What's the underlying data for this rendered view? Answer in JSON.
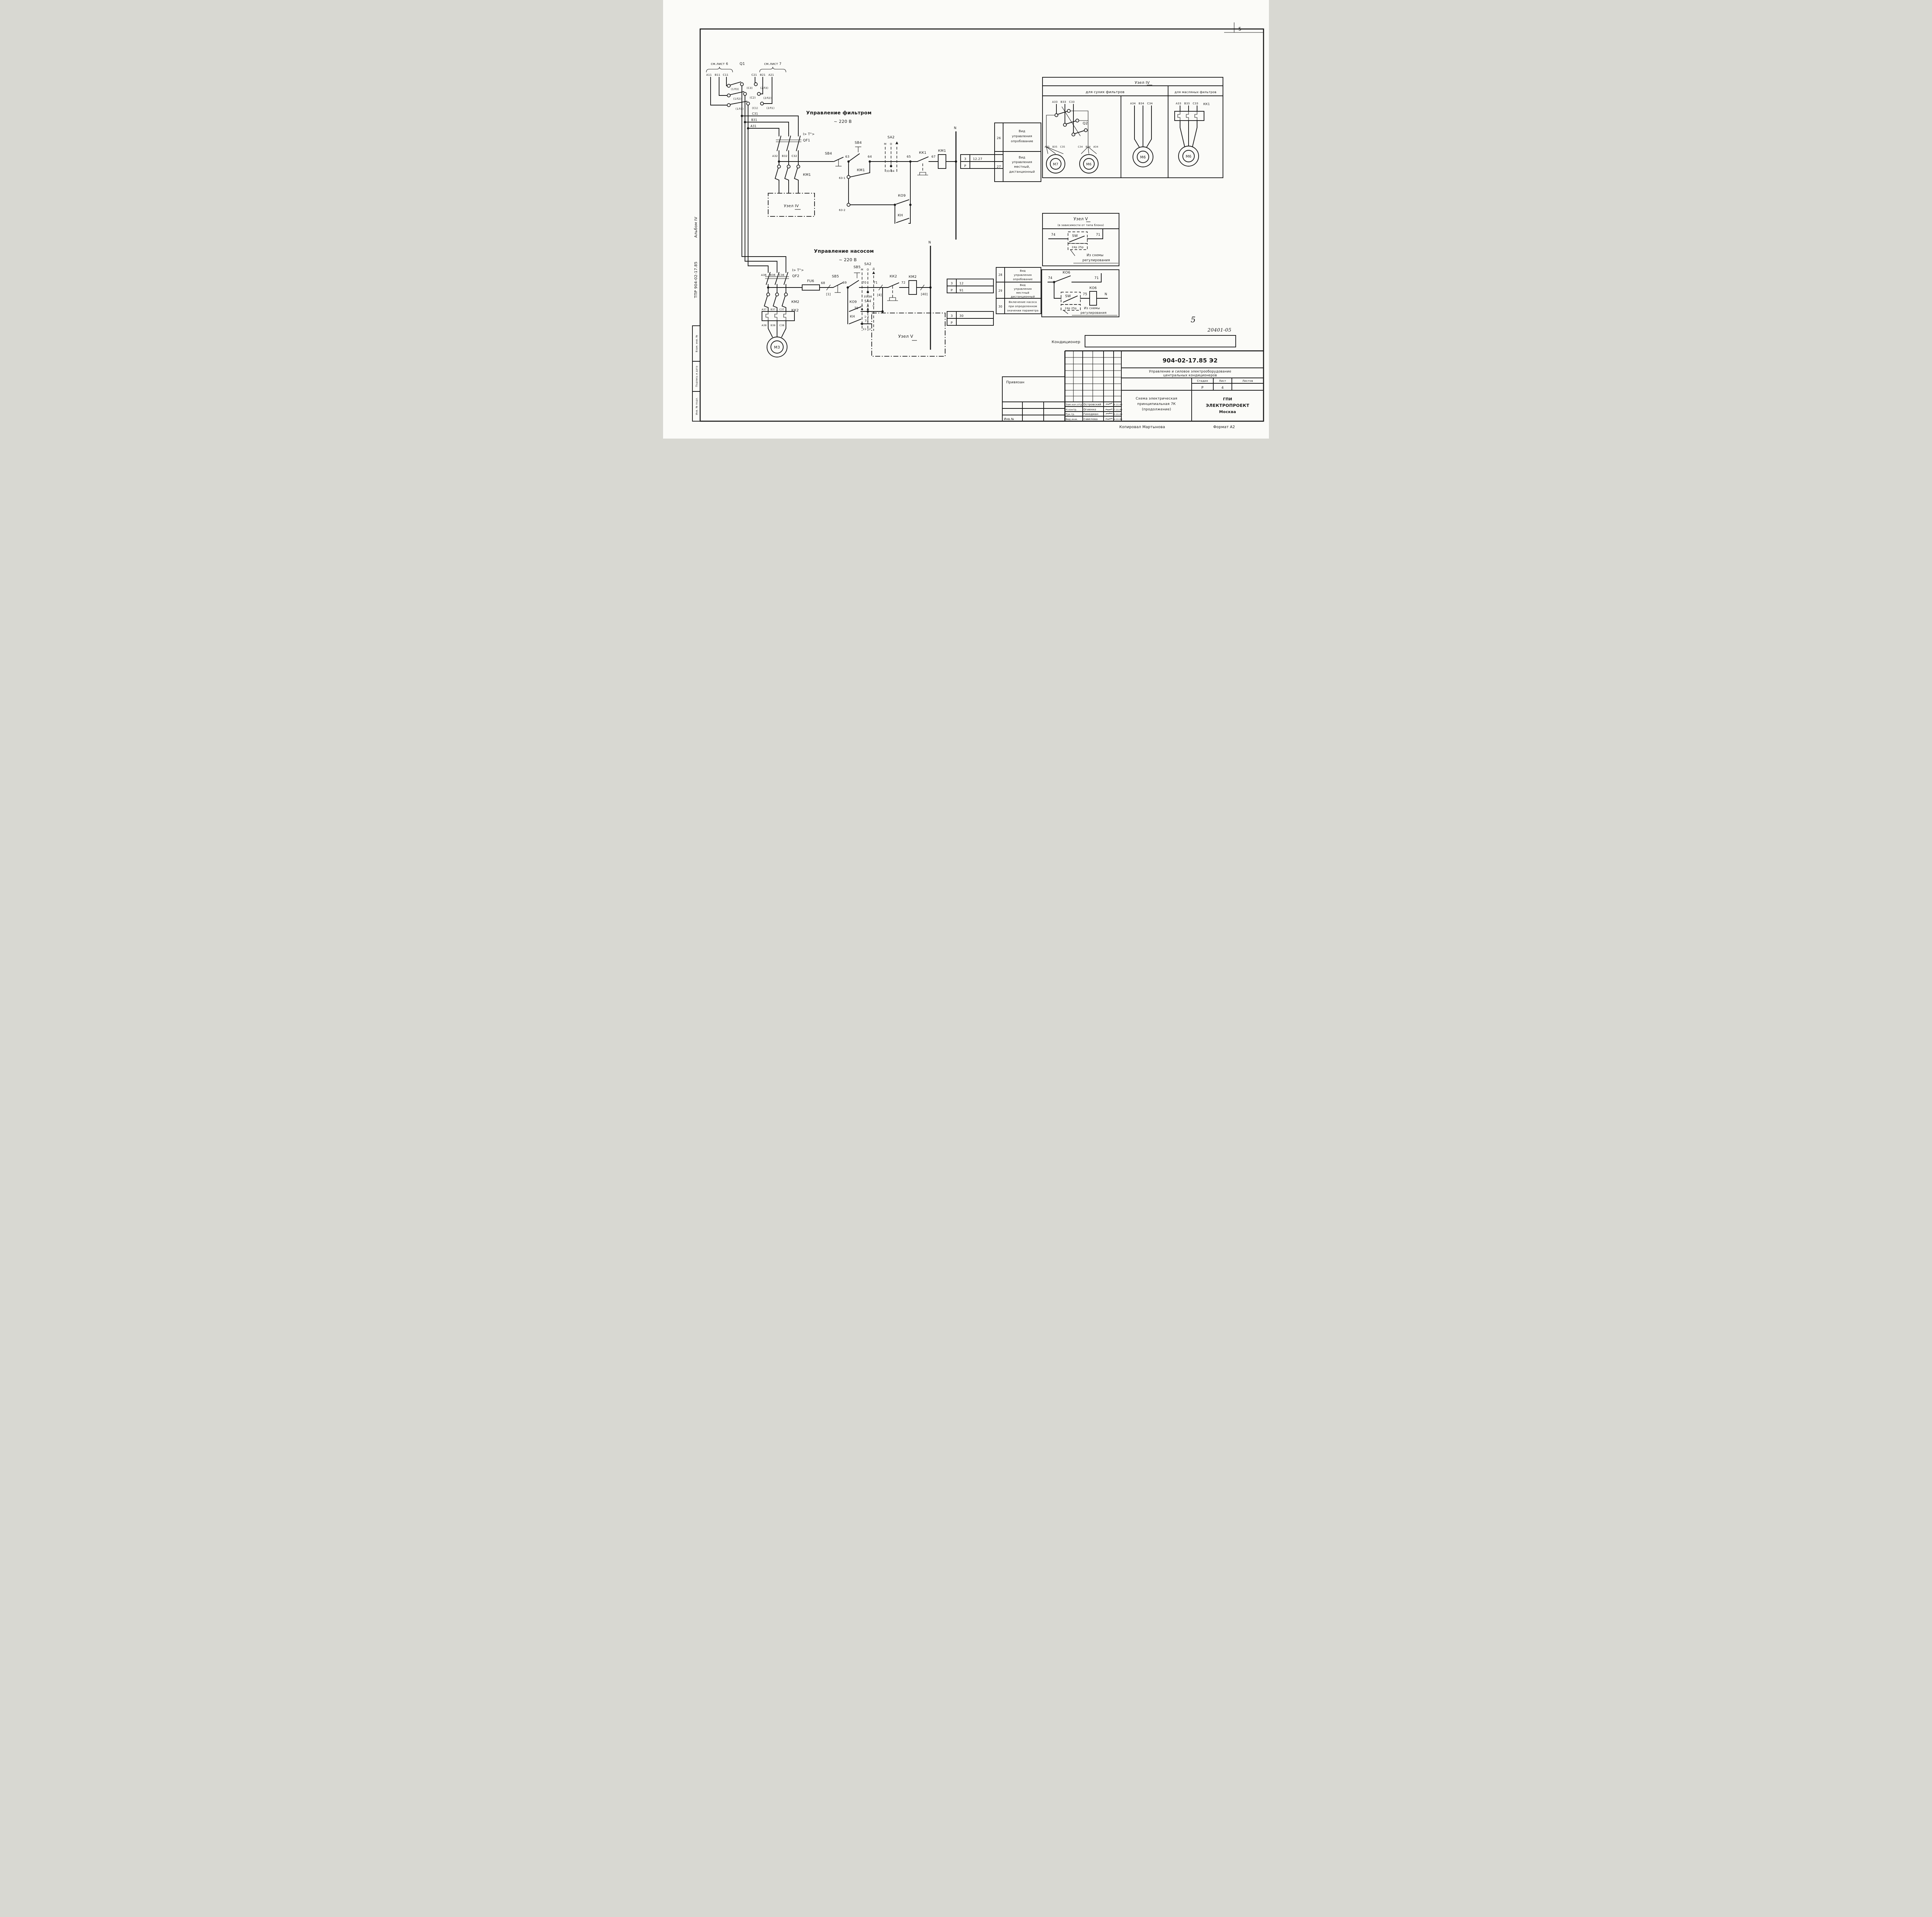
{
  "sheet": {
    "corner_num": "5",
    "hand_num": "5",
    "hand_code": "20401-05",
    "conditioner": "Кондиционер",
    "side_tpr": "ТПР  904-02-17.85",
    "side_album": "Альбом IV",
    "stamps": [
      "Взам. инв. №",
      "Подпись и дата",
      "Инв. № подл."
    ],
    "copied": "Копировал  Мартынова",
    "format": "Формат А2"
  },
  "q1": {
    "see6": "см.лист 6",
    "label": "Q1",
    "see7": "см.лист 7",
    "tl": [
      "А11",
      "В11",
      "С11"
    ],
    "tr": [
      "С21",
      "В21",
      "А21"
    ],
    "cl": [
      "(1Л3)",
      "(1Л2)",
      "(1Л1)"
    ],
    "cm": [
      "(С3)",
      "(С2)",
      "(С1)"
    ],
    "cr": [
      "(2Л3)",
      "(2Л2)",
      "(2Л1)"
    ],
    "bus": [
      "С31",
      "В31",
      "А31"
    ]
  },
  "filter": {
    "title": "Управление  фильтром",
    "volt": "~ 220 В",
    "rel": "I> T°>",
    "qf": "QF1",
    "poles": [
      "А32",
      "В32",
      "С32"
    ],
    "km": "КМ1",
    "uzel": "Узел IV",
    "sb": "SB4",
    "sb2": "SB4",
    "n63": "63",
    "n64": "64",
    "aux": "КМ1",
    "n631": "63-1",
    "n632": "63-2",
    "sa": "SA2",
    "saM": "М",
    "saO": "О",
    "saD": "Д",
    "sac": "33-34",
    "n65": "65",
    "kk": "КК1",
    "n67": "67",
    "coil": "КМ1",
    "n": "N",
    "ko9": "КО9",
    "kn": "КН",
    "ref": {
      "a": "3",
      "av": "12.27",
      "b": "Р",
      "bv": ""
    },
    "n26": "26",
    "t26": [
      "Вид",
      "управления",
      "опробование"
    ],
    "n27": "27",
    "t27": [
      "Вид",
      "управления",
      "местный,",
      "дистанционный"
    ]
  },
  "uzel4": {
    "title": "Узел IV",
    "dry": "для  сухих   фильтров",
    "oil": "для масляных фильтров",
    "s1": [
      "А33",
      "В33",
      "С33"
    ],
    "q2": "Q2",
    "m7t": [
      "А35",
      "В35",
      "С35"
    ],
    "m7": "М7",
    "m6at": [
      "С34",
      "В34",
      "А34"
    ],
    "m6a": "М6",
    "s2": [
      "А34",
      "В34",
      "С34"
    ],
    "m6b": "М6",
    "s3": [
      "А33",
      "В33",
      "С33"
    ],
    "kk1": "КК1",
    "m6c": "М6"
  },
  "uzel5": {
    "title": "Узел V",
    "sub": "(в зависимости от типа блока)",
    "n74": "74",
    "sw": "SW",
    "n71": "71",
    "plug": "24р 25р",
    "note1": "Из схемы",
    "note2": "регулирования"
  },
  "ko6": {
    "n74": "74",
    "k1": "КО6",
    "n71": "71",
    "sw": "SW",
    "plug": "24р 25р",
    "n75": "75",
    "k2": "КО6",
    "n": "N",
    "note1": "Из схемы",
    "note2": "регулирования"
  },
  "pump": {
    "title": "Управление  насосом",
    "volt": "~ 220 В",
    "rel": "I> T°>",
    "qf": "QF2",
    "fu": "FU6",
    "n68": "68",
    "b1": "[1]",
    "sb": "SB5",
    "sb2": "SB5",
    "n69": "69",
    "n70": "70",
    "sa2": "SA2",
    "saM": "М",
    "saO": "О",
    "saD": "Д",
    "sa2c": "35-36",
    "sa4": "SA4",
    "sa4A": "А",
    "sa4D": "Д",
    "sa4C": "С",
    "c12": "1-2",
    "c1112": "11-12",
    "ko9": "КО9",
    "n79": "79",
    "kn": "КН",
    "n74": "74",
    "n71": "71",
    "b4": "[4]",
    "kk": "КК2",
    "n72": "72",
    "coil": "КМ2",
    "b40": "[40]",
    "n": "N",
    "poles": [
      "А36",
      "В36",
      "С36"
    ],
    "km": "КМ2",
    "kkb": "КК2",
    "t37": [
      "А37",
      "В37",
      "С37"
    ],
    "t38": [
      "А38",
      "В38",
      "С38"
    ],
    "motor": "М3",
    "uzel": "Узел V",
    "ref1": {
      "a": "3",
      "av": "12",
      "b": "Р",
      "bv": "91"
    },
    "ref2": {
      "a": "3",
      "av": "30",
      "b": "Р",
      "bv": ""
    },
    "n28": "28",
    "t28": [
      "Вид",
      "управления",
      "опробование"
    ],
    "n29": "29",
    "t29": [
      "Вид",
      "управления",
      "местный",
      "дистанционный"
    ],
    "n30": "30",
    "t30": [
      "Включение  насоса",
      "при определенном",
      "значении параметра"
    ]
  },
  "tb": {
    "privyazan": "Привязан",
    "inv": "Инв.№",
    "r1role": "Зам.нач.отд",
    "r1name": "Островский",
    "r1date": "16.11.83",
    "r2role": "Н.контр.",
    "r2name": "Огиенко",
    "r2date": "17.11.83",
    "r3role": "Рук.гр.",
    "r3name": "Гинодман",
    "r3date": "15.11.83",
    "r4role": "Вед.инж.",
    "r4name": "Савелова",
    "r4date": "14.11.83",
    "code": "904-02-17.85  Э2",
    "subj1": "Управление  и  силовое  электрооборудование",
    "subj2": "центральных     кондиционеров",
    "sh1": "Стадия",
    "sh2": "Лист",
    "sh3": "Листов",
    "sv1": "Р",
    "sv2": "4",
    "scheme1": "Схема  электрическая",
    "scheme2": "принципиальная 7К",
    "scheme3": "(продолжение)",
    "org1": "ГПИ",
    "org2": "ЭЛЕКТРОПРОЕКТ",
    "org3": "Москва"
  }
}
